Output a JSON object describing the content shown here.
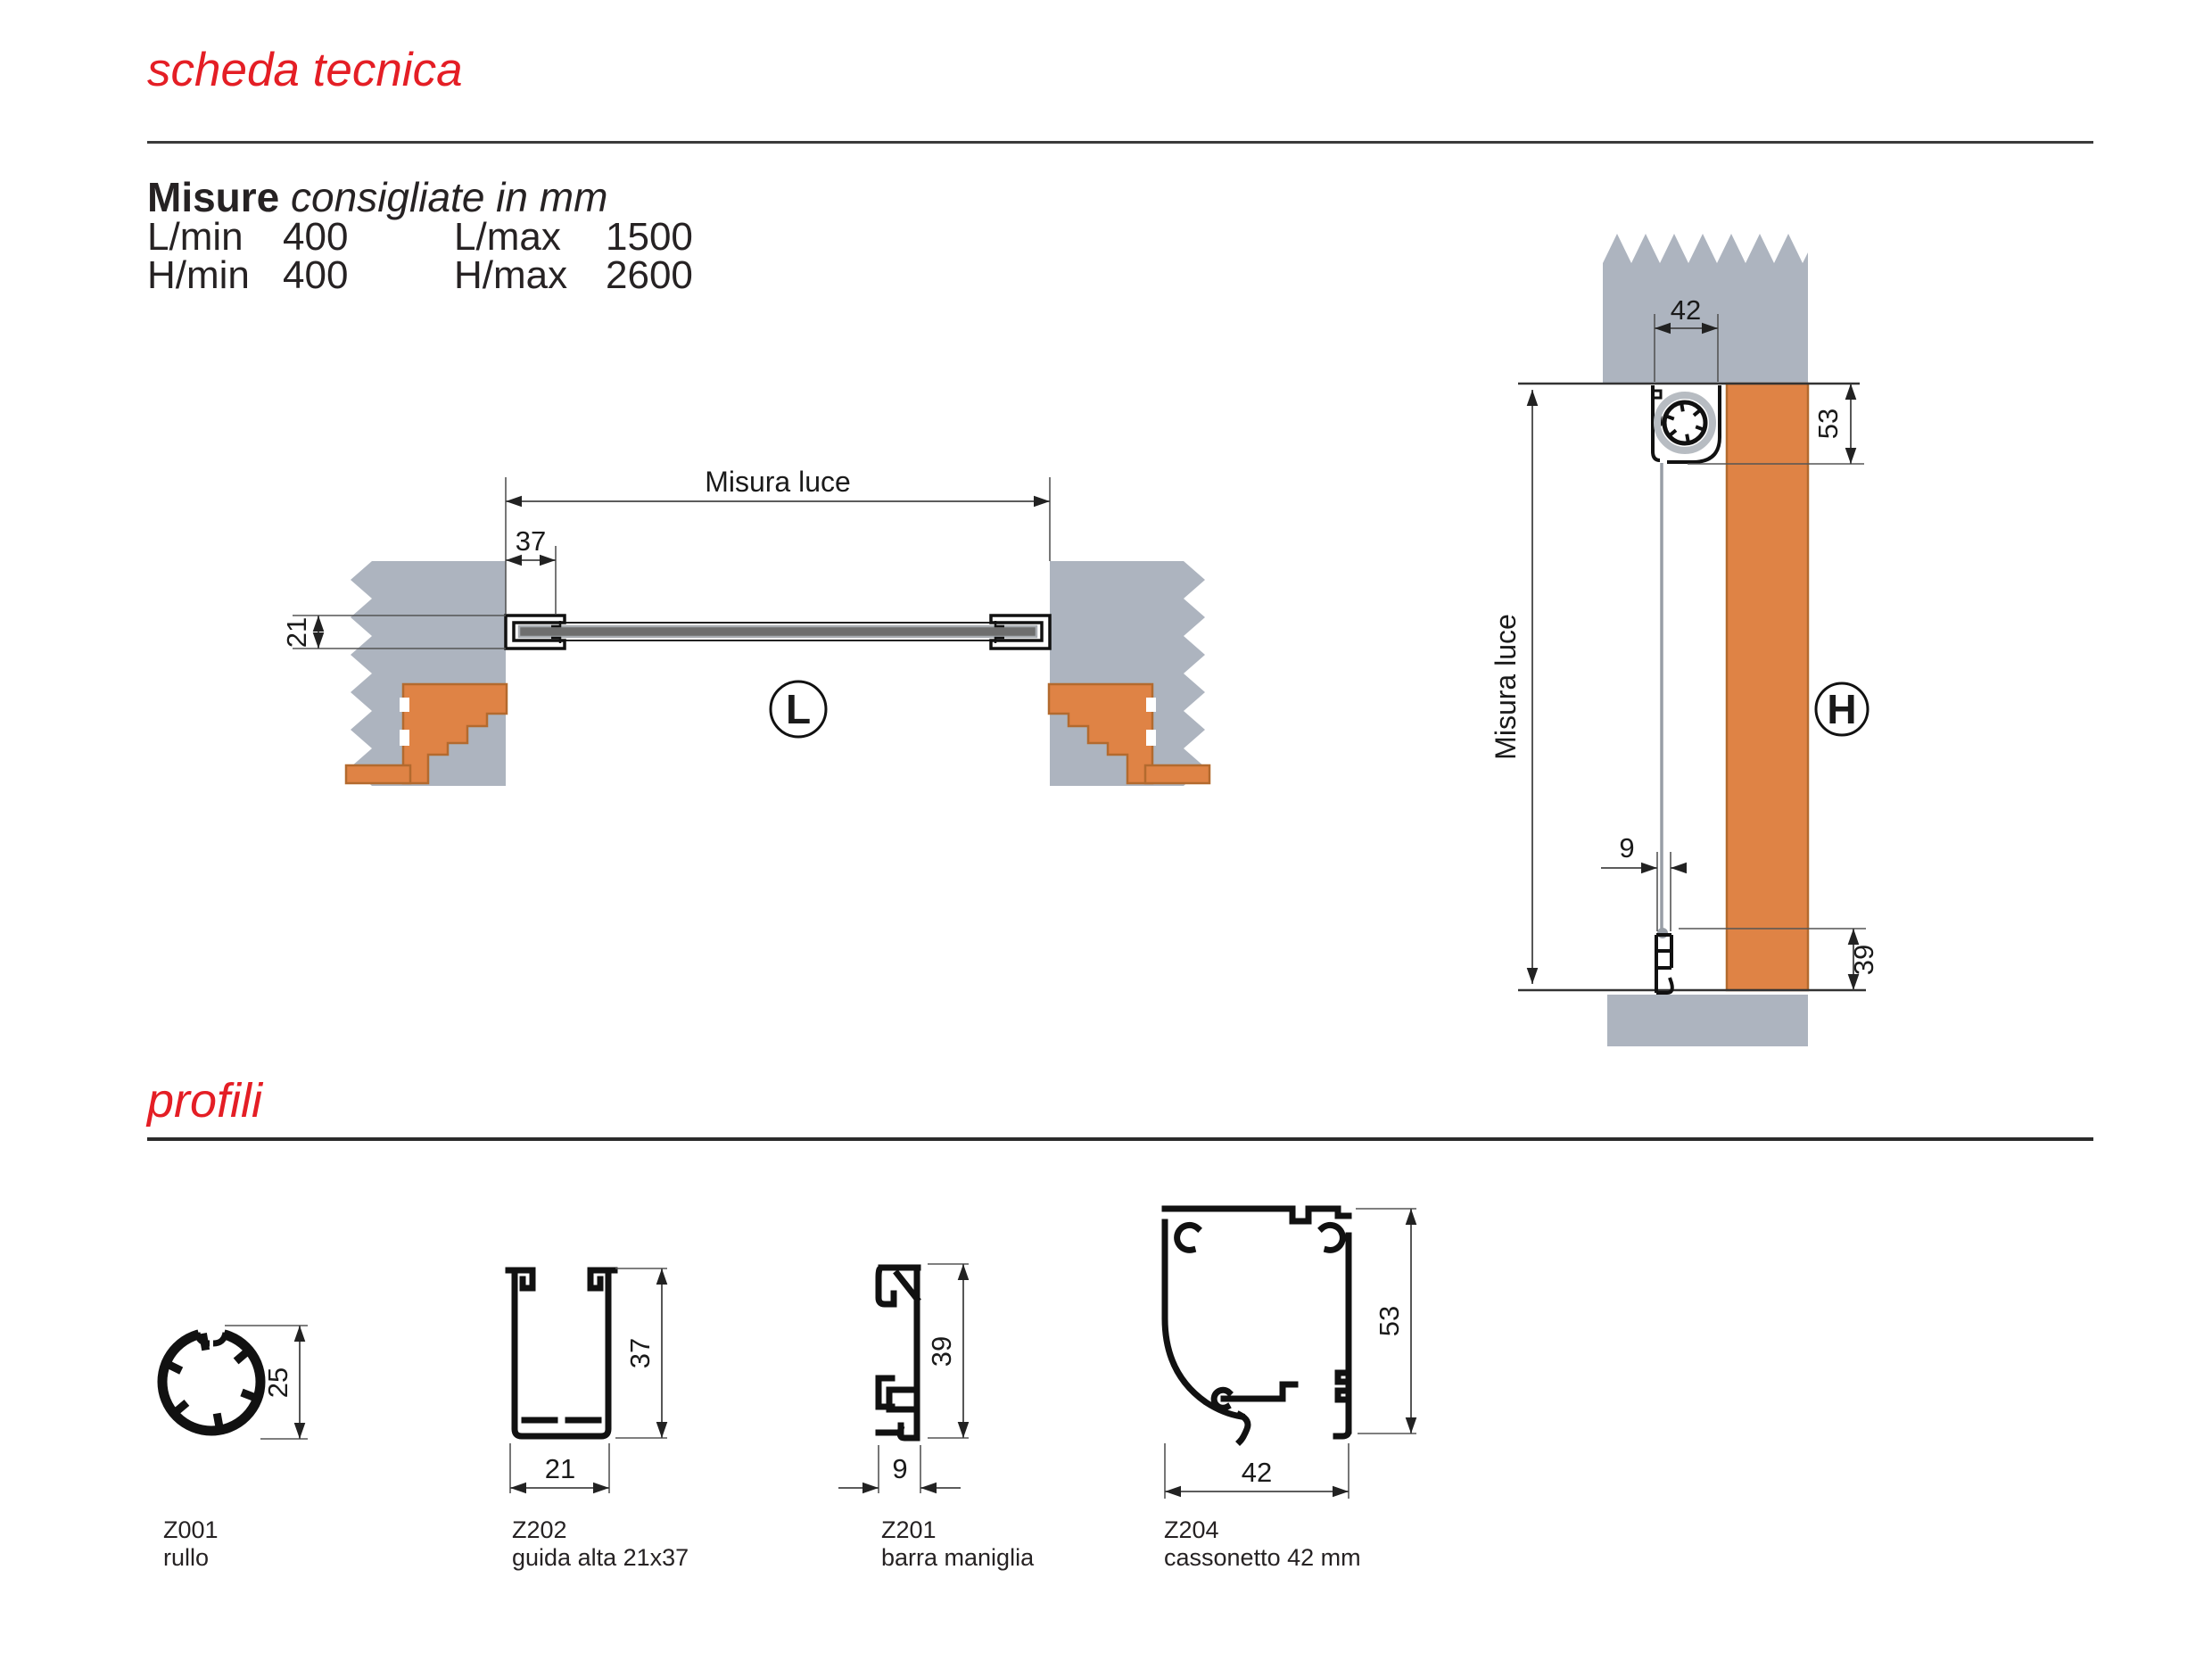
{
  "header": {
    "title": "scheda tecnica"
  },
  "measures": {
    "heading_bold": "Misure",
    "heading_italic": "consigliate in mm",
    "rows": [
      {
        "label_left": "L/min",
        "value_left": "400",
        "label_right": "L/max",
        "value_right": "1500"
      },
      {
        "label_left": "H/min",
        "value_left": "400",
        "label_right": "H/max",
        "value_right": "2600"
      }
    ]
  },
  "drawing_l": {
    "badge": "L",
    "misura_luce": "Misura luce",
    "dim_guide_depth": "37",
    "dim_guide_width": "21"
  },
  "drawing_h": {
    "badge": "H",
    "misura_luce": "Misura luce",
    "dim_box_width": "42",
    "dim_box_height": "53",
    "dim_bar_width": "9",
    "dim_bar_height": "39"
  },
  "profiles_section": {
    "title": "profili",
    "items": [
      {
        "code": "Z001",
        "name": "rullo",
        "dim_a": "25"
      },
      {
        "code": "Z202",
        "name": "guida alta 21x37",
        "dim_a": "37",
        "dim_b": "21"
      },
      {
        "code": "Z201",
        "name": "barra maniglia",
        "dim_a": "39",
        "dim_b": "9"
      },
      {
        "code": "Z204",
        "name": "cassonetto 42 mm",
        "dim_a": "53",
        "dim_b": "42"
      }
    ]
  },
  "colors": {
    "accent_red": "#e41e25",
    "wall_gray": "#adb4bf",
    "brick_orange": "#df8345",
    "brick_border": "#b36a2e",
    "slat_gray": "#6e6e6e",
    "line_dark": "#2b2b2b"
  }
}
